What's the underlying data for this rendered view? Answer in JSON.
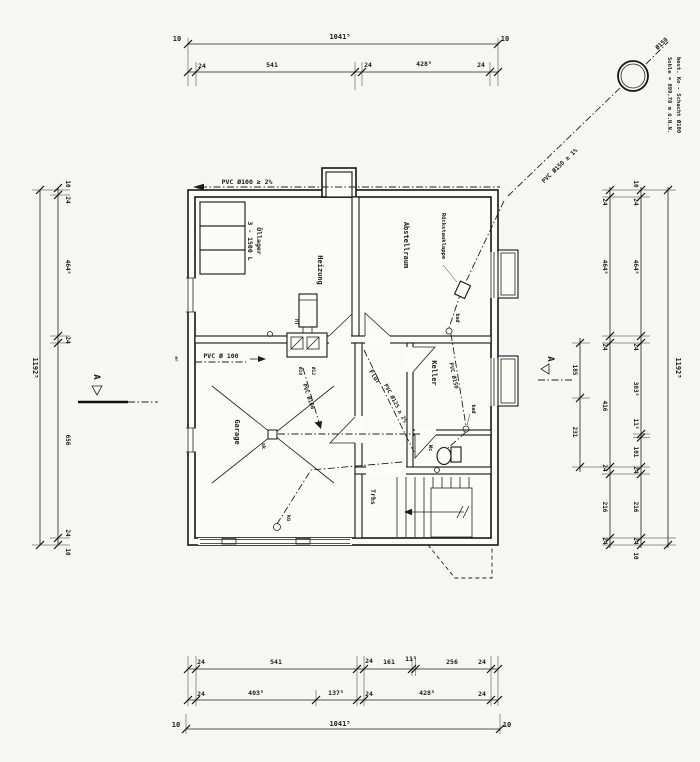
{
  "manhole": {
    "line1": "best. Ko - Schacht Ø100",
    "line2": "Sohle = 899,78 m ü.N.N.",
    "pipe": "Ø150"
  },
  "pipes": {
    "top": "PVC Ø100 ≥ 2%",
    "to_shaft": "PVC Ø150 ≥ 1%",
    "keller": "PVC Ø150",
    "flur": "PVC Ø125 ≥ 2%",
    "garage_h": "PVC Ø 100",
    "garage_d": "PVC Ø100"
  },
  "rooms": {
    "heizung": "Heizung",
    "oel1": "Öllager",
    "oel2": "3 - 1500 L",
    "abstell": "Abstellraum",
    "rueckstau": "Rückstauklappe",
    "garage": "Garage",
    "flur": "Flur",
    "keller": "Keller",
    "wc": "Wc",
    "trhs": "Trhs"
  },
  "marks": {
    "sk": "sk",
    "kue": "kü",
    "bad_oben": "bad",
    "bad_unten": "bad",
    "ht": "HT",
    "d10": "Ø10",
    "d12": "Ø12",
    "er": "er",
    "section": "A"
  },
  "dims": {
    "top1": [
      "10",
      "1041⁵",
      "10"
    ],
    "top2": [
      "24",
      "541",
      "24",
      "428⁵",
      "24"
    ],
    "bot1": [
      "24",
      "541",
      "24",
      "161",
      "11⁵",
      "256",
      "24"
    ],
    "bot2": [
      "24",
      "403⁵",
      "137⁵",
      "24",
      "428⁵",
      "24"
    ],
    "bot3": [
      "10",
      "1041⁵",
      "10"
    ],
    "left_total": "1192⁵",
    "left": [
      "10",
      "24",
      "464⁵",
      "24",
      "656",
      "24",
      "10"
    ],
    "right1": [
      "185",
      "231"
    ],
    "right2": [
      "24",
      "464⁵",
      "24",
      "416",
      "24",
      "216",
      "24"
    ],
    "right3": [
      "10",
      "24",
      "464⁵",
      "24",
      "303⁵",
      "11⁵",
      "101",
      "24",
      "216",
      "24",
      "10"
    ],
    "right_total": "1192⁵"
  }
}
